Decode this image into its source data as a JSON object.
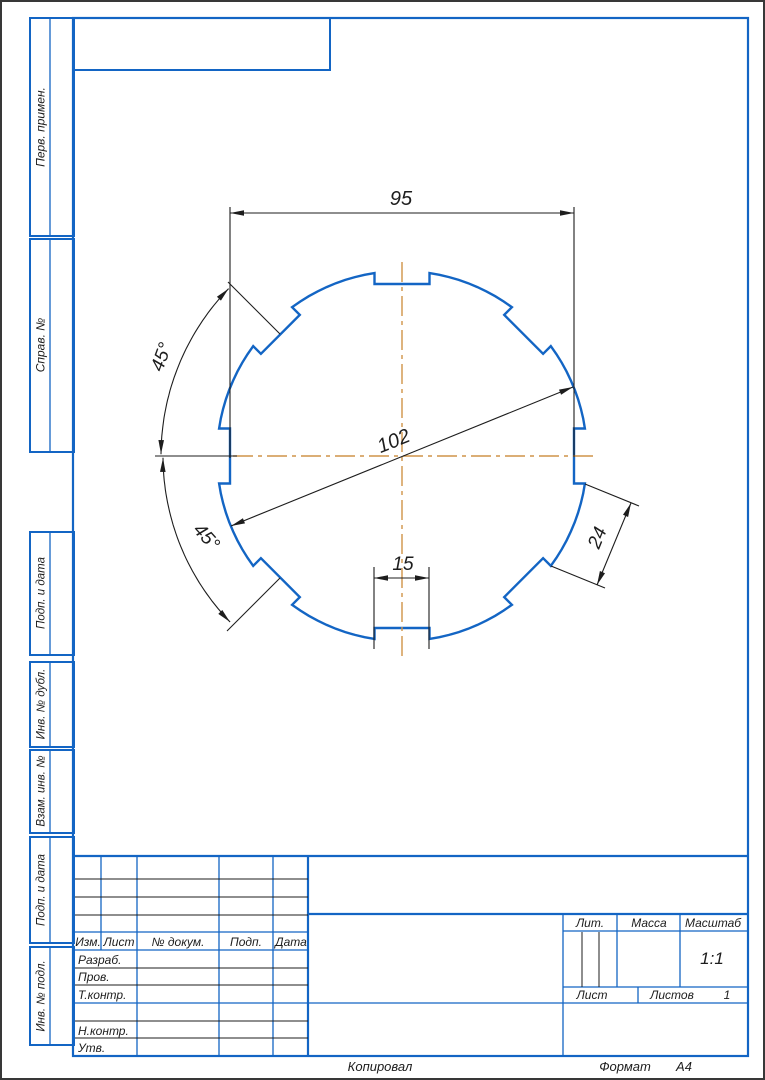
{
  "drawing": {
    "dimensions": {
      "across_flats": "95",
      "outer_diameter": "102",
      "slot_width": "15",
      "tooth_width": "24",
      "angle_upper": "45°",
      "angle_lower": "45°"
    },
    "part": {
      "description": "circular disc with 8 rectangular slots",
      "slot_count": 8,
      "slot_pitch_deg": 45,
      "outer_diameter": 102,
      "across_flats": 95,
      "slot_width": 15,
      "tooth_chord": 24
    }
  },
  "margin_labels": {
    "perv": "Перв. примен.",
    "sprav": "Справ. №",
    "podp1": "Подп. и дата",
    "inv_dubl": "Инв. № дубл.",
    "vzam": "Взам. инв. №",
    "podp2": "Подп. и дата",
    "inv_podl": "Инв. № подл."
  },
  "title_block": {
    "col_izm": "Изм.",
    "col_list": "Лист",
    "col_doc": "№ докум.",
    "col_podp": "Подп.",
    "col_data": "Дата",
    "row_razrab": "Разраб.",
    "row_prov": "Пров.",
    "row_tkontr": "Т.контр.",
    "row_nkontr": "Н.контр.",
    "row_utv": "Утв.",
    "lit": "Лит.",
    "massa": "Масса",
    "masshtab": "Масштаб",
    "scale": "1:1",
    "list": "Лист",
    "listov": "Листов",
    "listov_value": "1"
  },
  "footer": {
    "kopiroval": "Копировал",
    "format_label": "Формат",
    "format_value": "А4"
  },
  "colors": {
    "line_blue": "#1365c4",
    "centerline_orange": "#cf9348",
    "dim_black": "#1d1d1d",
    "page_border": "#383838"
  }
}
